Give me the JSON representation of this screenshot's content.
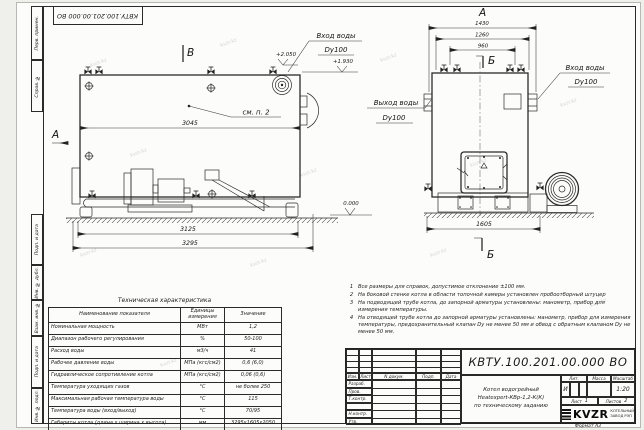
{
  "watermark": "kvzr.kz",
  "sheet": {
    "doc_number": "КВТУ.100.201.00.000 ВО",
    "format_label": "Формат",
    "format_value": "А3"
  },
  "margin_labels": {
    "perv": "Перв. примен.",
    "sprav": "Справ. №",
    "podp1": "Подп. и дата",
    "inv_dubl": "Инв. № дубл.",
    "vzam": "Взам. инв. №",
    "podp2": "Подп. и дата",
    "inv_podl": "Инв. № подл."
  },
  "side_view": {
    "section_b": "В",
    "view_a": "А",
    "see_note": "см. п. 2",
    "dim_3045": "3045",
    "dim_3125": "3125",
    "dim_3295": "3295",
    "elev_2050": "+2.050",
    "elev_1930": "+1.930",
    "elev_0": "0.000",
    "inlet_line1": "Вход воды",
    "inlet_line2": "Dy100"
  },
  "front_view": {
    "view_a": "А",
    "section_b_top": "Б",
    "section_b_bottom": "Б",
    "dim_1430": "1430",
    "dim_1260": "1260",
    "dim_960": "960",
    "dim_1605": "1605",
    "outlet_line1": "Выход воды",
    "outlet_line2": "Dy100",
    "inlet_line1": "Вход воды",
    "inlet_line2": "Dy100"
  },
  "notes": [
    {
      "num": "1",
      "text": "Все размеры для справок, допустимое отклонение ±100 мм."
    },
    {
      "num": "2",
      "text": "На боковой стенке котла в области топочной камеры установлен пробоотборный штуцер"
    },
    {
      "num": "3",
      "text": "На подводящей трубе котла, до запорной арматуры установлены: манометр, прибор для измерения температуры."
    },
    {
      "num": "4",
      "text": "На отводящей трубе котла до запорной арматуры установлены: манометр, прибор для измерения температуры, предохранительный клапан Dу не менее 50 мм и обвод с обратным клапаном Dу не менее 50 мм."
    }
  ],
  "spec_table": {
    "title": "Техническая характеристика",
    "headers": [
      "Наименование показателя",
      "Единицы измерения",
      "Значение"
    ],
    "rows": [
      [
        "Номинальная мощность",
        "МВт",
        "1,2"
      ],
      [
        "Диапазон рабочего регулирования",
        "%",
        "50-100"
      ],
      [
        "Расход воды",
        "м3/ч",
        "41"
      ],
      [
        "Рабочее давление воды",
        "МПа (кгс/см2)",
        "0,6 (6,0)"
      ],
      [
        "Гидравлическое сопротивление котла",
        "МПа (кгс/см2)",
        "0,06 (0,6)"
      ],
      [
        "Температура уходящих газов",
        "°С",
        "не более 250"
      ],
      [
        "Максимальная рабочая температура воды",
        "°С",
        "115"
      ],
      [
        "Температура воды (вход/выход)",
        "°С",
        "70/95"
      ],
      [
        "Габариты котла (длина х ширина х высота)",
        "мм",
        "3295х1605х2050"
      ]
    ]
  },
  "title_block": {
    "doc_number": "КВТУ.100.201.00.000 ВО",
    "cols": [
      "Изм.",
      "Лист",
      "N докум.",
      "Подп.",
      "Дата"
    ],
    "rows": [
      "Разраб.",
      "Пров.",
      "Т.контр.",
      "",
      "Н.контр.",
      "Утв."
    ],
    "name_line1": "Котел водогрейный",
    "name_line2": "Heatexpert-КВр-1,2-К(К)",
    "name_line3": "по техническому заданию",
    "lit_label": "Лит.",
    "lit_value": "И",
    "mass_label": "Масса",
    "scale_label": "Масштаб",
    "scale_value": "1:20",
    "sheet_label": "Лист",
    "sheet_value": "1",
    "sheets_label": "Листов",
    "sheets_value": "2",
    "logo_text": "KVZR",
    "company_line1": "КОТЕЛЬНЫЙ",
    "company_line2": "ЗАВОД РЭП"
  }
}
